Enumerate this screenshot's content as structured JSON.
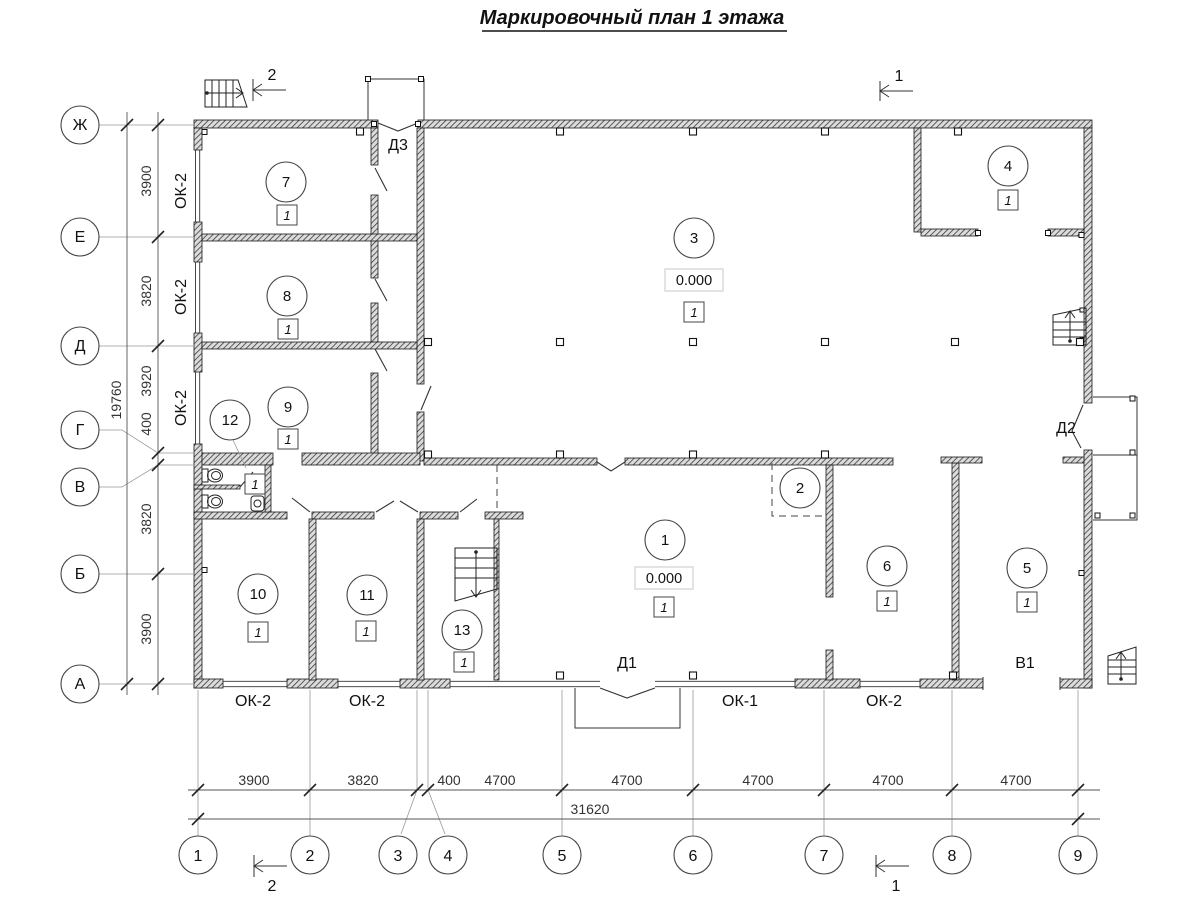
{
  "title": "Маркировочный план 1 этажа",
  "axes": {
    "rows": [
      {
        "label": "Ж"
      },
      {
        "label": "Е"
      },
      {
        "label": "Д"
      },
      {
        "label": "Г"
      },
      {
        "label": "В"
      },
      {
        "label": "Б"
      },
      {
        "label": "А"
      }
    ],
    "cols": [
      {
        "label": "1"
      },
      {
        "label": "2"
      },
      {
        "label": "3"
      },
      {
        "label": "4"
      },
      {
        "label": "5"
      },
      {
        "label": "6"
      },
      {
        "label": "7"
      },
      {
        "label": "8"
      },
      {
        "label": "9"
      }
    ]
  },
  "dims": {
    "left": [
      "3900",
      "3820",
      "3920",
      "400",
      "3820",
      "3900"
    ],
    "left_total": "19760",
    "bottom": [
      "3900",
      "3820",
      "400",
      "4700",
      "4700",
      "4700",
      "4700",
      "4700"
    ],
    "bottom_total": "31620"
  },
  "rooms": [
    {
      "num": "1",
      "level": "0.000",
      "floor": "1"
    },
    {
      "num": "2"
    },
    {
      "num": "3",
      "level": "0.000",
      "floor": "1"
    },
    {
      "num": "4",
      "floor": "1"
    },
    {
      "num": "5",
      "floor": "1"
    },
    {
      "num": "6",
      "floor": "1"
    },
    {
      "num": "7",
      "floor": "1"
    },
    {
      "num": "8",
      "floor": "1"
    },
    {
      "num": "9",
      "floor": "1"
    },
    {
      "num": "10",
      "floor": "1"
    },
    {
      "num": "11",
      "floor": "1"
    },
    {
      "num": "12",
      "floor": "1"
    },
    {
      "num": "13",
      "floor": "1"
    }
  ],
  "openings": {
    "door1": "Д1",
    "door2": "Д2",
    "door3": "Д3",
    "gate1": "В1",
    "window1": "ОК-1",
    "window2": "ОК-2"
  },
  "sections": {
    "s1": "1",
    "s2": "2"
  }
}
